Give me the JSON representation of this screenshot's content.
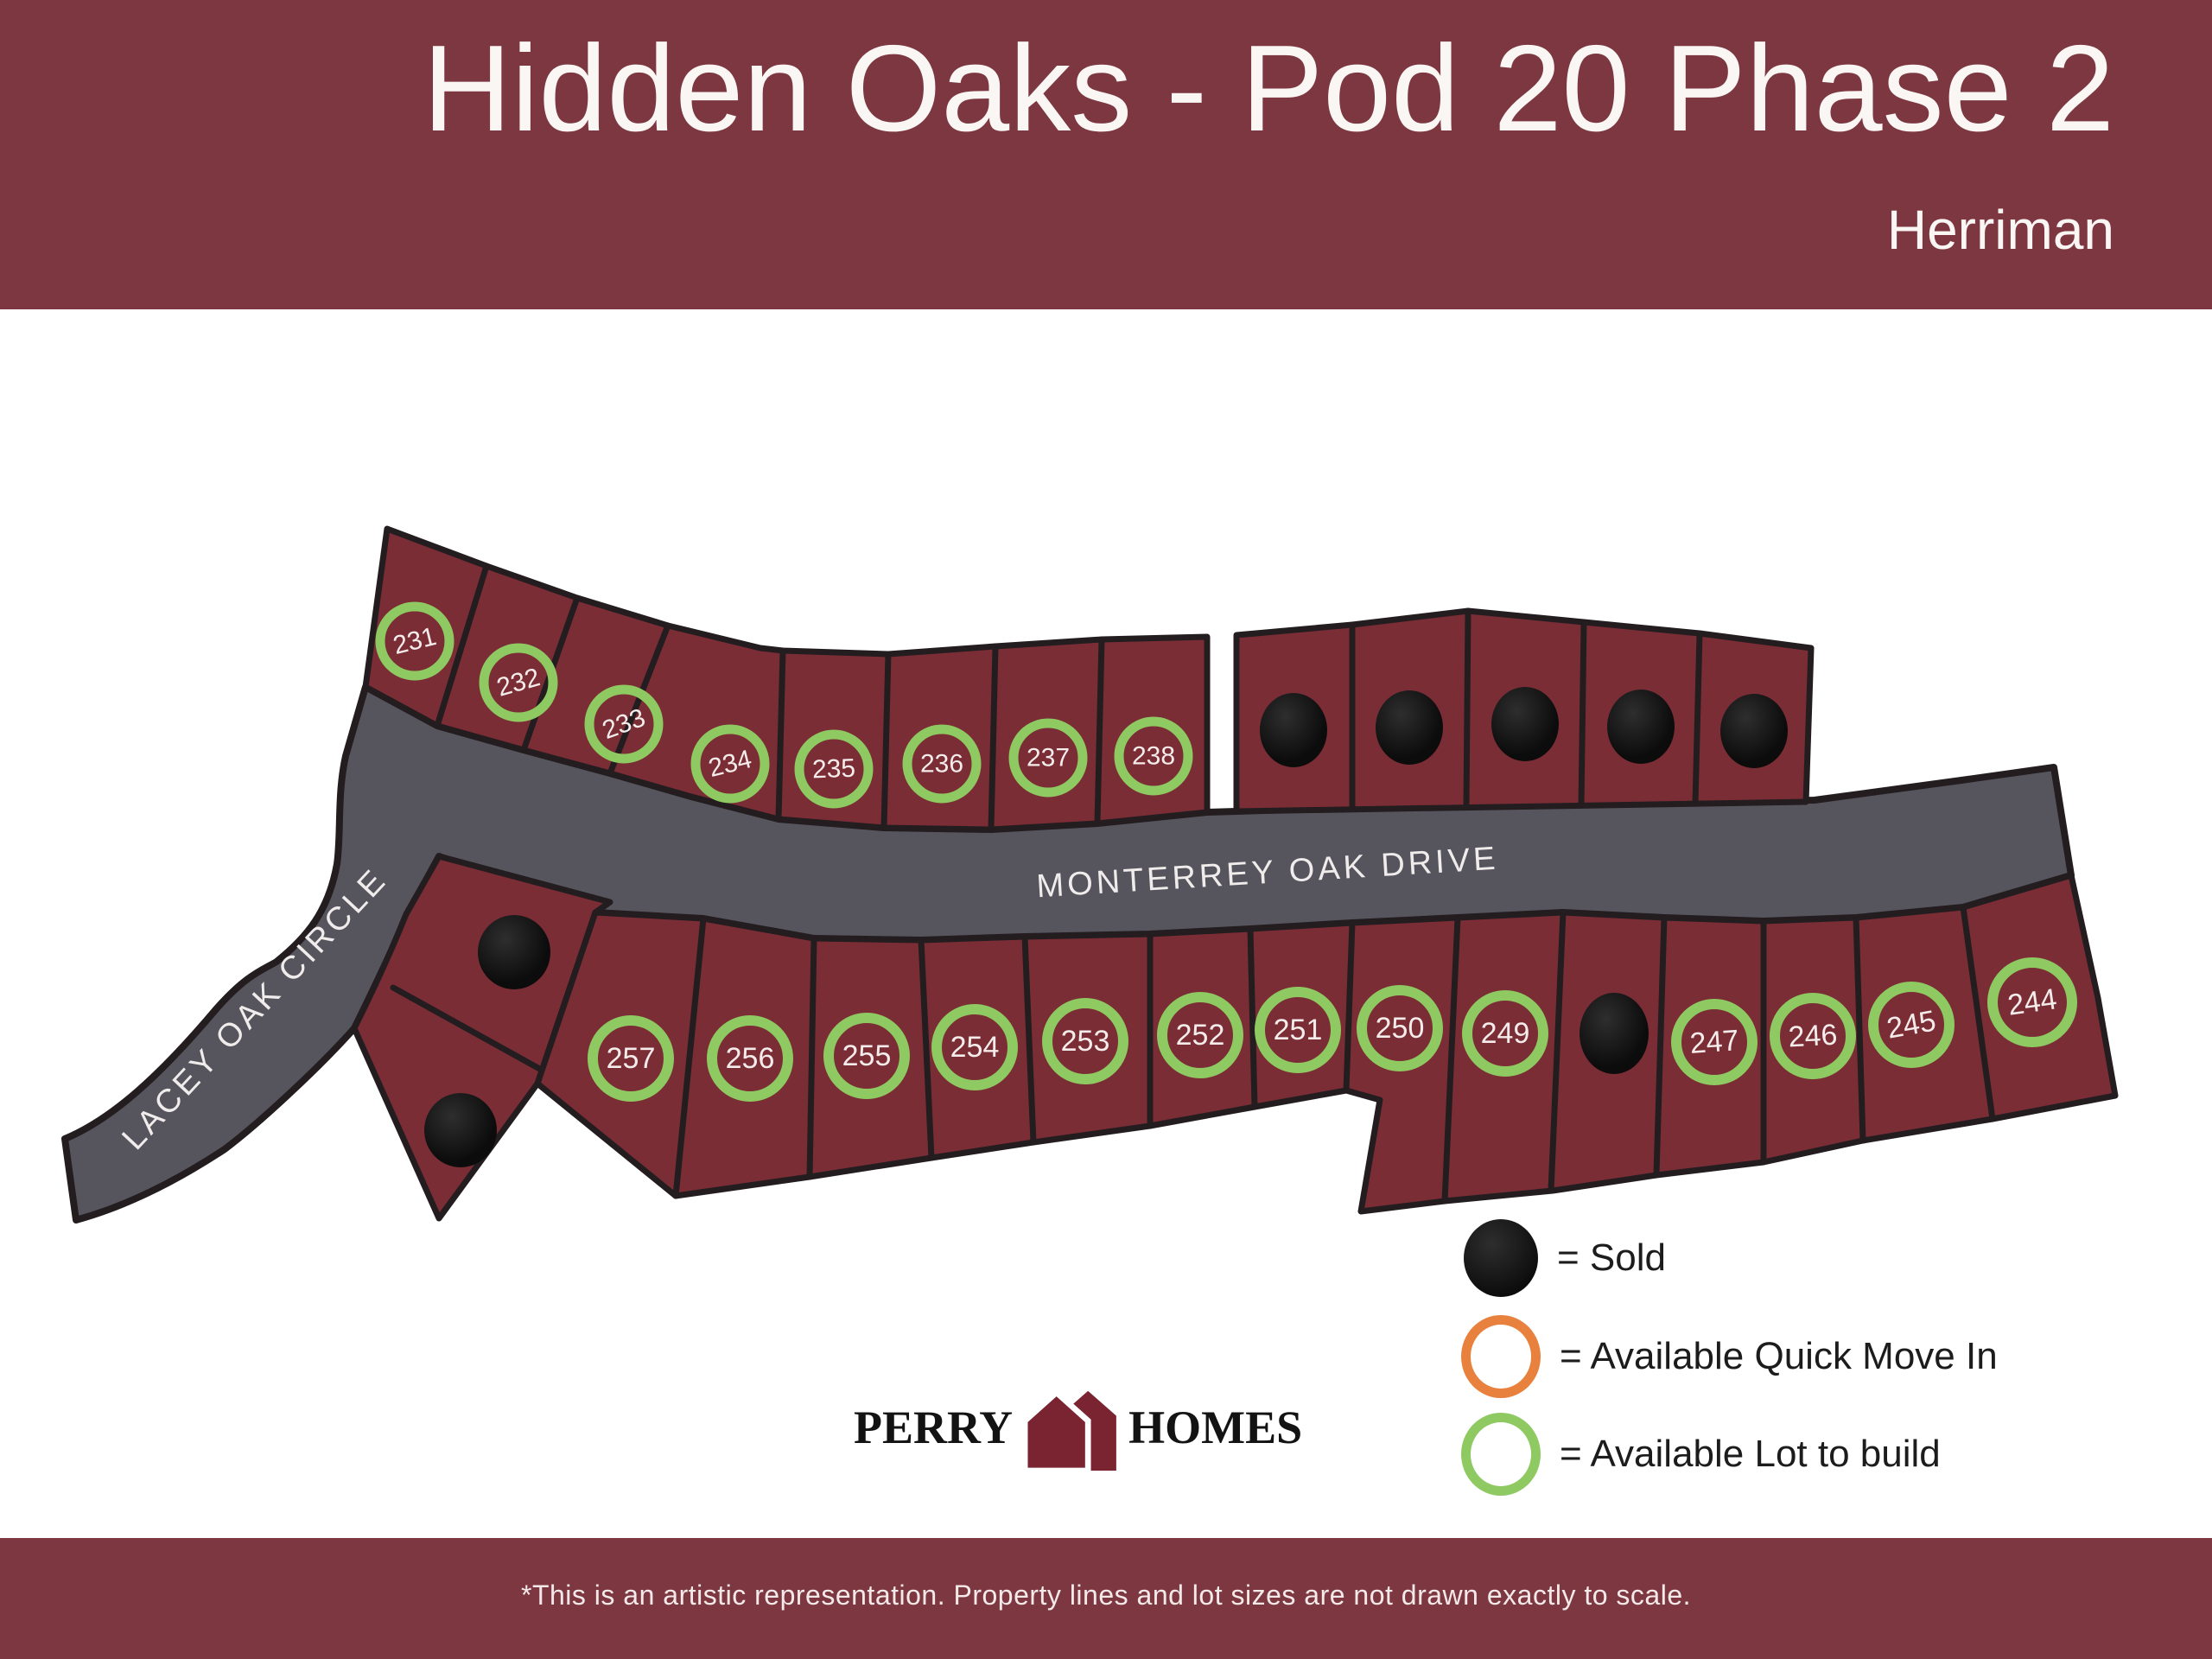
{
  "header": {
    "title": "Hidden Oaks - Pod 20 Phase 2",
    "subtitle": "Herriman"
  },
  "roads": [
    {
      "name": "MONTERREY OAK DRIVE"
    },
    {
      "name": "LACEY OAK CIRCLE"
    }
  ],
  "lots": [
    {
      "number": "231",
      "status": "available-lot-to-build"
    },
    {
      "number": "232",
      "status": "available-lot-to-build"
    },
    {
      "number": "233",
      "status": "available-lot-to-build"
    },
    {
      "number": "234",
      "status": "available-lot-to-build"
    },
    {
      "number": "235",
      "status": "available-lot-to-build"
    },
    {
      "number": "236",
      "status": "available-lot-to-build"
    },
    {
      "number": "237",
      "status": "available-lot-to-build"
    },
    {
      "number": "238",
      "status": "available-lot-to-build"
    },
    {
      "number": null,
      "status": "sold"
    },
    {
      "number": null,
      "status": "sold"
    },
    {
      "number": null,
      "status": "sold"
    },
    {
      "number": null,
      "status": "sold"
    },
    {
      "number": null,
      "status": "sold"
    },
    {
      "number": null,
      "status": "sold"
    },
    {
      "number": null,
      "status": "sold"
    },
    {
      "number": "257",
      "status": "available-lot-to-build"
    },
    {
      "number": "256",
      "status": "available-lot-to-build"
    },
    {
      "number": "255",
      "status": "available-lot-to-build"
    },
    {
      "number": "254",
      "status": "available-lot-to-build"
    },
    {
      "number": "253",
      "status": "available-lot-to-build"
    },
    {
      "number": "252",
      "status": "available-lot-to-build"
    },
    {
      "number": "251",
      "status": "available-lot-to-build"
    },
    {
      "number": "250",
      "status": "available-lot-to-build"
    },
    {
      "number": "249",
      "status": "available-lot-to-build"
    },
    {
      "number": null,
      "status": "sold"
    },
    {
      "number": "247",
      "status": "available-lot-to-build"
    },
    {
      "number": "246",
      "status": "available-lot-to-build"
    },
    {
      "number": "245",
      "status": "available-lot-to-build"
    },
    {
      "number": "244",
      "status": "available-lot-to-build"
    }
  ],
  "legend": {
    "items": [
      {
        "label": "= Sold",
        "symbol": "sold-filled-circle",
        "color": "#0c0c0c"
      },
      {
        "label": "= Available Quick Move In",
        "symbol": "orange-ring",
        "color": "#e8813e"
      },
      {
        "label": "= Available Lot to build",
        "symbol": "green-ring",
        "color": "#8ec961"
      }
    ]
  },
  "logo": {
    "word_left": "PERRY",
    "word_right": "HOMES"
  },
  "footer": {
    "disclaimer": "*This is an artistic representation. Property lines and lot sizes are not drawn exactly to scale."
  },
  "colors": {
    "banner_maroon": "#7d3741",
    "lot_maroon": "#7b2d36",
    "road_gray": "#56555d",
    "available_green": "#8ec961",
    "quick_move_orange": "#e8813e",
    "sold_black": "#0c0c0c",
    "logo_maroon": "#7a2431"
  }
}
